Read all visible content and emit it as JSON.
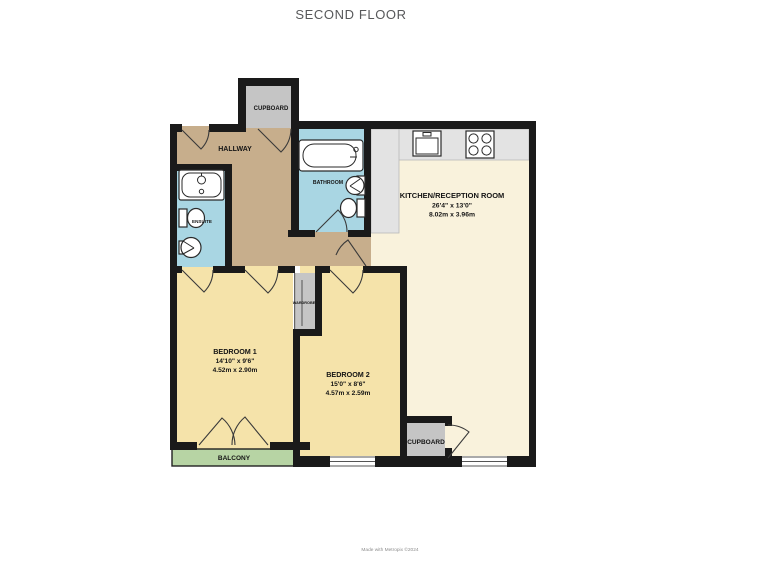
{
  "title": "SECOND FLOOR",
  "footer": "Made with Metropix ©2024",
  "colors": {
    "wall": "#1a1a1a",
    "hallway": "#c7ae8c",
    "bedroom": "#f5e3aa",
    "kitchen": "#f9f2dc",
    "bathroom": "#a9d6e3",
    "balcony": "#b7d4a4",
    "storage": "#c5c5c5",
    "counter": "#e3e3e3"
  },
  "rooms": {
    "hallway": {
      "name": "HALLWAY"
    },
    "cupboard_top": {
      "name": "CUPBOARD"
    },
    "bathroom": {
      "name": "BATHROOM"
    },
    "ensuite": {
      "name": "ENSUITE"
    },
    "kitchen": {
      "name": "KITCHEN/RECEPTION ROOM",
      "dims_imperial": "26'4\" x 13'0\"",
      "dims_metric": "8.02m x 3.96m"
    },
    "bedroom1": {
      "name": "BEDROOM 1",
      "dims_imperial": "14'10\" x 9'6\"",
      "dims_metric": "4.52m x 2.90m"
    },
    "bedroom2": {
      "name": "BEDROOM 2",
      "dims_imperial": "15'0\" x 8'6\"",
      "dims_metric": "4.57m x 2.59m"
    },
    "wardrobe": {
      "name": "WARDROBE"
    },
    "balcony": {
      "name": "BALCONY"
    },
    "cupboard_bottom": {
      "name": "CUPBOARD"
    }
  }
}
